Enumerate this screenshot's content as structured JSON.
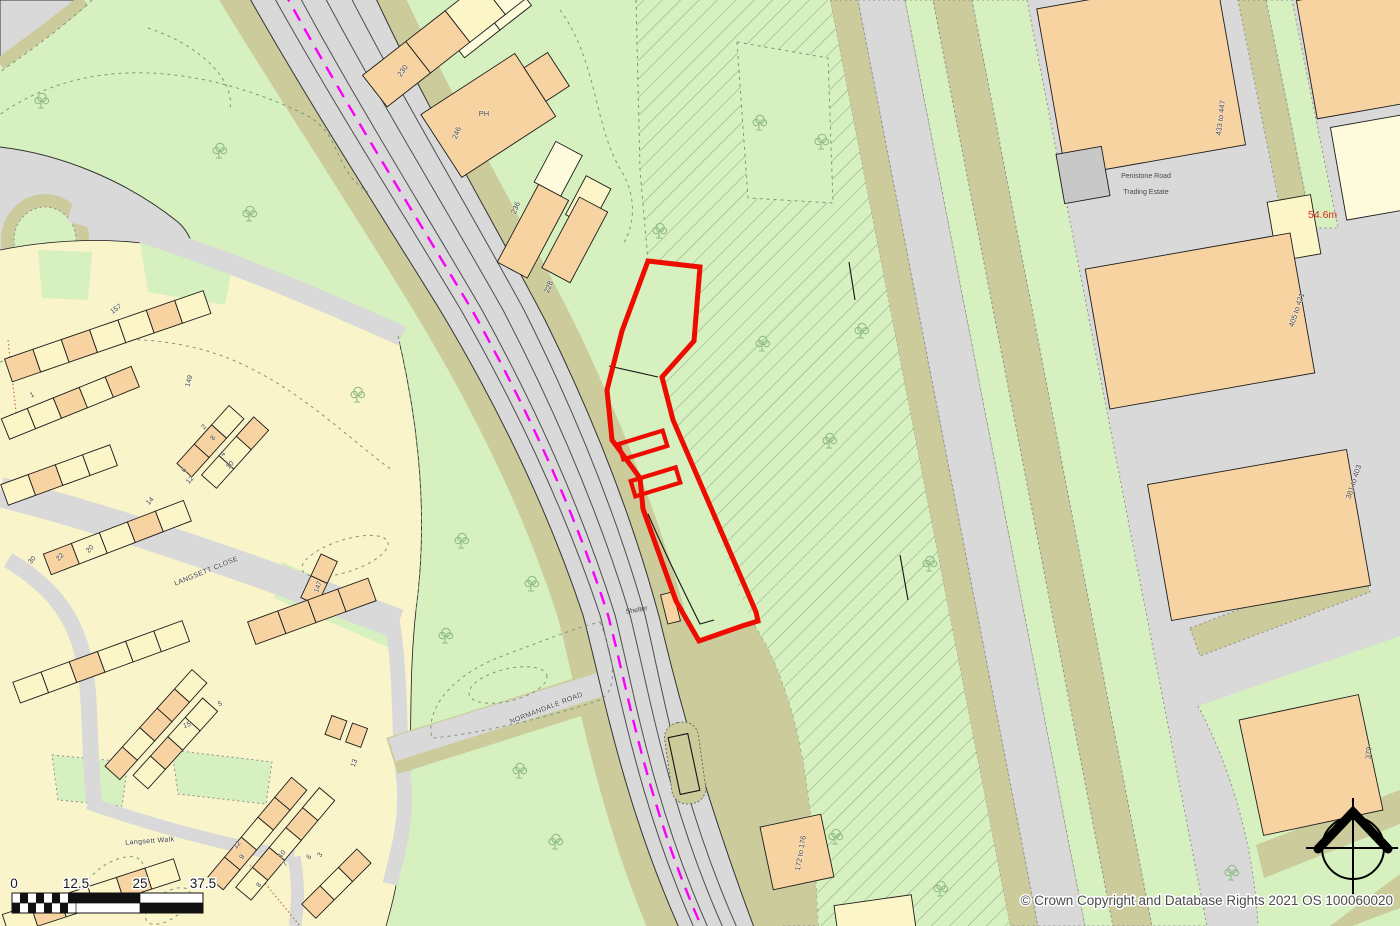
{
  "map": {
    "street_labels": {
      "langsett_close": "LANGSETT CLOSE",
      "langsett_walk": "Langsett Walk",
      "normandale_road": "NORMANDALE ROAD",
      "penistone_road_line1": "Penistone Road",
      "penistone_road_line2": "Trading Estate",
      "shelter": "Shelter"
    },
    "spot_height": "54.6m",
    "building_labels": {
      "b230": "230",
      "b_ph": "PH",
      "b246": "246",
      "b236": "236",
      "b228": "228",
      "r433": "433 to 447",
      "r405": "405 to 421",
      "r381": "381 to 403",
      "r379": "379",
      "r172": "172 to 176"
    },
    "house_numbers": {
      "n157": "157",
      "n149": "149",
      "n1": "1",
      "n2": "2",
      "n8a": "8",
      "n4": "4",
      "n10a": "10",
      "n6a": "6",
      "n12a": "12",
      "n14": "14",
      "n20": "20",
      "n22": "22",
      "n30": "30",
      "n147": "147",
      "n5": "5",
      "n15": "15",
      "n13": "13",
      "n12b": "12",
      "n9": "9",
      "n10b": "10",
      "n7": "7",
      "n6b": "6",
      "n3": "3",
      "n8b": "8"
    },
    "scale_bar": {
      "t0": "0",
      "t1": "12.5",
      "t2": "25",
      "t3": "37.5"
    },
    "copyright": "© Crown Copyright and Database Rights 2021 OS 100060020",
    "colors": {
      "green": "#D6F0BF",
      "hatch_line": "#86A383",
      "road": "#D9D9D9",
      "khaki": "#CBCB9C",
      "peach": "#F8D3A2",
      "cream": "#FBF5C8",
      "pale": "#FEFBDC",
      "estate": "#FAF4CA",
      "building_gray": "#C8C8C8",
      "red_boundary": "#EE0B00",
      "magenta": "#FA00FA",
      "tree": "#90BC84",
      "dash_veg": "#7E957E",
      "outline": "#1C1C1C",
      "red_text": "#E0271E"
    }
  }
}
